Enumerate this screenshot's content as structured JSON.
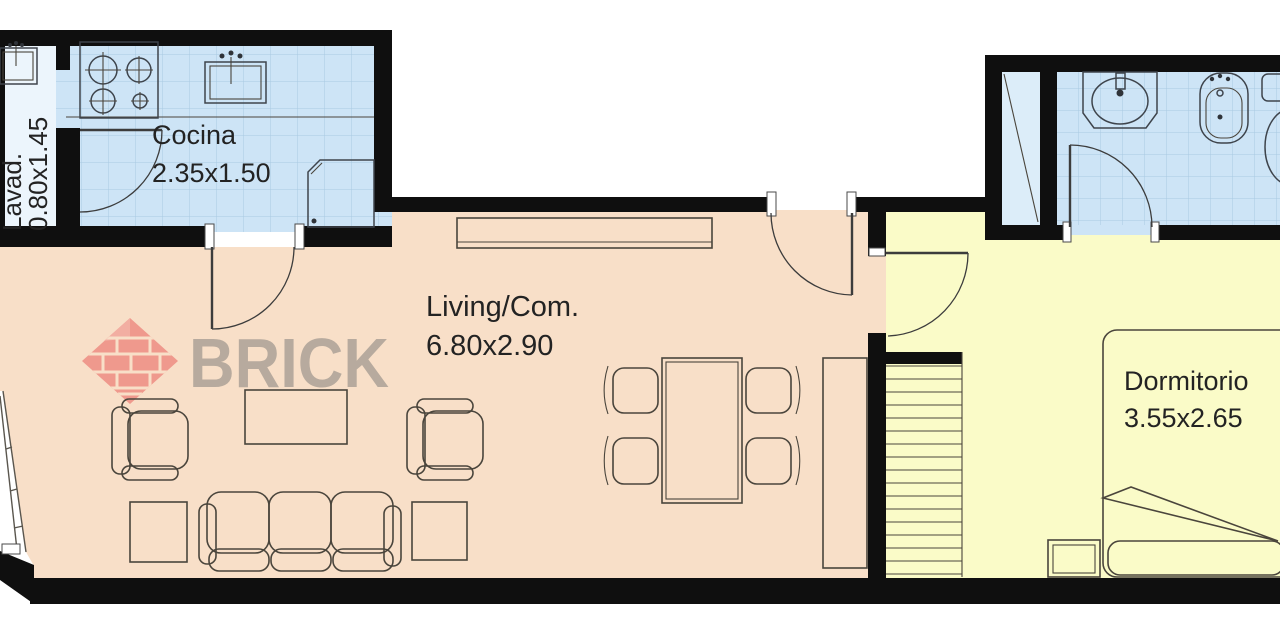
{
  "brand": {
    "name": "BRICK",
    "text_color": "#9c948b",
    "diamond_color": "#ee8d83",
    "diamond_color_light": "#f2a69c"
  },
  "rooms": {
    "lavadero": {
      "label": "Lavad.",
      "dims": "0.80x1.45",
      "floor_color": "#ecf5fc"
    },
    "cocina": {
      "label": "Cocina",
      "dims": "2.35x1.50",
      "floor_color": "#cde4f6"
    },
    "living": {
      "label": "Living/Com.",
      "dims": "6.80x2.90",
      "floor_color": "#f8dfc8"
    },
    "dormitorio": {
      "label": "Dormitorio",
      "dims": "3.55x2.65",
      "floor_color": "#fafbc8"
    },
    "bano": {
      "floor_color": "#cde4f6",
      "shower_floor_color": "#dcedf9"
    }
  },
  "styles": {
    "wall_color": "#0f0f0f",
    "furniture_stroke": "#4a453c",
    "tile_line_color": "#a9cae2",
    "label_color": "#232323"
  }
}
